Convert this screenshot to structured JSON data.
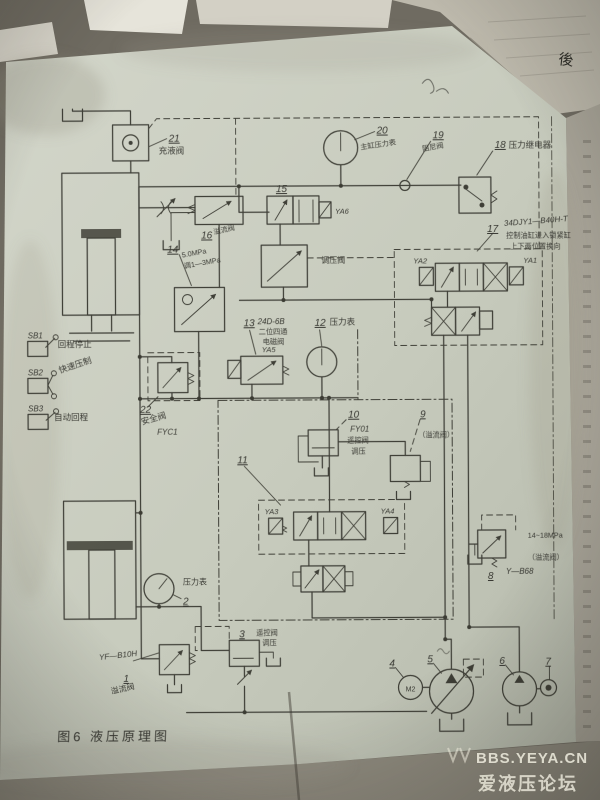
{
  "colors": {
    "backdrop": "#6f6b61",
    "paper": "#cbcfc2",
    "ink": "#33332c",
    "watermark": "#efeddf"
  },
  "photo": {
    "caption": "图6  液压原理图",
    "watermark_line1": "BBS.YEYA.CN",
    "watermark_line2": "爱液压论坛",
    "corner_note": "後"
  },
  "switches": [
    {
      "id": "SB1",
      "label": "回程停止"
    },
    {
      "id": "SB2",
      "label": "快速压制"
    },
    {
      "id": "SB3",
      "label": "自动回程"
    }
  ],
  "solenoids": [
    "YA1",
    "YA2",
    "YA3",
    "YA4",
    "YA5",
    "YA6"
  ],
  "motor_label": "M2",
  "components": {
    "c1": {
      "no": "1",
      "model": "YF—B10H",
      "name": "溢流阀"
    },
    "c2": {
      "no": "2",
      "name": "压力表"
    },
    "c3": {
      "no": "3",
      "name": "遥控阀",
      "name2": "调压"
    },
    "c4": {
      "no": "4"
    },
    "c5": {
      "no": "5"
    },
    "c6": {
      "no": "6"
    },
    "c7": {
      "no": "7"
    },
    "c8": {
      "no": "8",
      "name": "14~18MPa",
      "name2": "（溢流阀）",
      "model": "Y—B68"
    },
    "c9": {
      "no": "9",
      "name": "（溢流阀）"
    },
    "c10": {
      "no": "10",
      "model": "FY01",
      "name": "遥控阀",
      "name2": "调压"
    },
    "c11": {
      "no": "11"
    },
    "c12": {
      "no": "12",
      "name": "压力表"
    },
    "c13": {
      "no": "13",
      "model": "24D-6B",
      "name": "二位四通",
      "name2": "电磁阀"
    },
    "c14": {
      "no": "14",
      "name": "5.0MPa",
      "name2": "调1—3MPa"
    },
    "c15": {
      "no": "15",
      "name": "调压阀"
    },
    "c16": {
      "no": "16",
      "name": "溢流阀"
    },
    "c17": {
      "no": "17",
      "model": "34DJY1—B40H-T",
      "name": "控制油缸进入锁紧缸",
      "name2": "上下两位置换向"
    },
    "c18": {
      "no": "18",
      "name": "压力继电器"
    },
    "c19": {
      "no": "19",
      "name": "阻尼阀"
    },
    "c20": {
      "no": "20",
      "name": "主缸压力表"
    },
    "c21": {
      "no": "21",
      "name": "充液阀"
    },
    "c22": {
      "no": "22",
      "name": "安全阀",
      "model": "FYC1"
    }
  }
}
